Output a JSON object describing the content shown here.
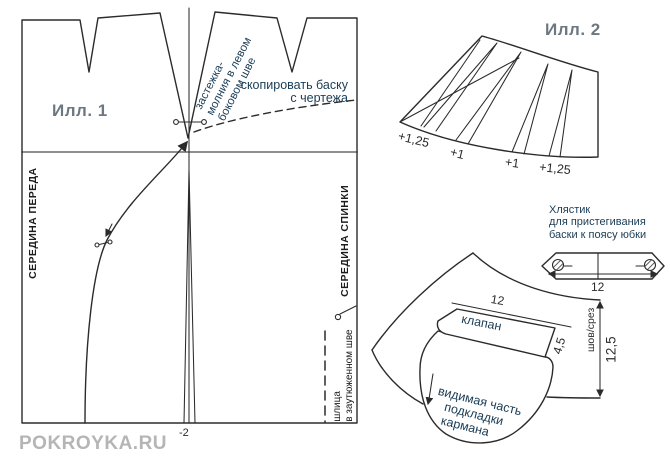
{
  "watermark": "POKROYKA.RU",
  "ill1": {
    "title": "Илл. 1",
    "zipper_note": {
      "line1": "застежка-",
      "line2": "молния в левом",
      "line3": "боковом шве"
    },
    "copy_note": {
      "line1": "скопировать баску",
      "line2": "с чертежа"
    },
    "front_center": "СЕРЕДИНА ПЕРЕДА",
    "back_center": "СЕРЕДИНА СПИНКИ",
    "vent_note": {
      "line1": "шлица",
      "line2": "в заутюженном шве"
    },
    "hem_adjust": "-2"
  },
  "ill2": {
    "title": "Илл. 2",
    "spread_labels": [
      "+1,25",
      "+1",
      "+1",
      "+1,25"
    ]
  },
  "tab": {
    "note": {
      "line1": "Хлястик",
      "line2": "для пристегивания",
      "line3": "баски к поясу юбки"
    },
    "width_dim": "12"
  },
  "pocket": {
    "flap_label": "клапан",
    "flap_width": "12",
    "flap_height": "4,5",
    "seam_label": "шов/срез",
    "depth_dim": "12,5",
    "lining_note": {
      "line1": "видимая часть",
      "line2": "подкладки",
      "line3": "кармана"
    }
  },
  "colors": {
    "ink": "#2b2b2b",
    "annotation": "#1a3c55",
    "muted-title": "#6d7780",
    "watermark": "#b5b5b5",
    "hip-line": "#8f8f8f"
  }
}
